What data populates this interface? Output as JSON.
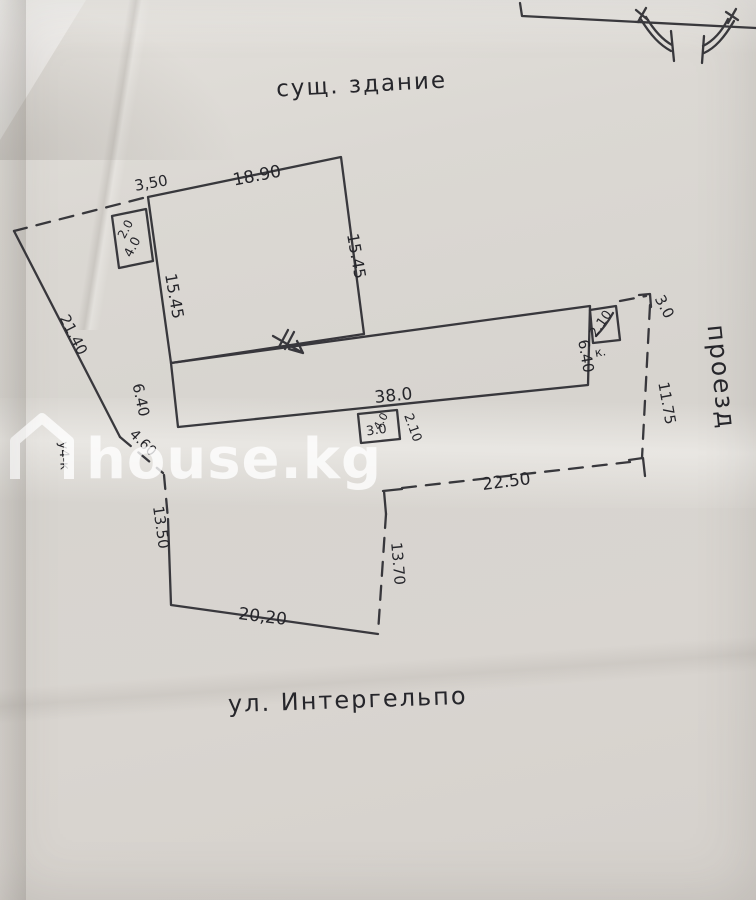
{
  "annotations": {
    "existing_building": "сущ. здание",
    "street": "ул. Интергельпо",
    "passage": "проезд",
    "left_code": "у4-к"
  },
  "dimensions": {
    "setback_top": "3,50",
    "upper_top": "18.90",
    "upper_right": "15.45",
    "upper_left": "15.45",
    "annex_a": "2.0",
    "annex_b": "4.0",
    "long_length": "38.0",
    "long_left": "6.40",
    "long_right": "6.40",
    "box_bottom_inner": "3.0",
    "box_bottom_inner2": "4.0",
    "box_bottom_side": "2.10",
    "box_right_inner": "2.10",
    "box_right_note": "к.",
    "gap_right": "3.0",
    "boundary_left": "21.40",
    "boundary_left_gap": "4.60",
    "passage_length": "11.75",
    "lower_top": "22.50",
    "lower_left": "13.50",
    "lower_right": "13.70",
    "lower_bottom": "20,20"
  },
  "watermark": {
    "brand": "house.kg"
  },
  "appearance": {
    "ink": "#2c2c31",
    "paper": "#d8d5d0",
    "watermark": "#ffffff"
  }
}
